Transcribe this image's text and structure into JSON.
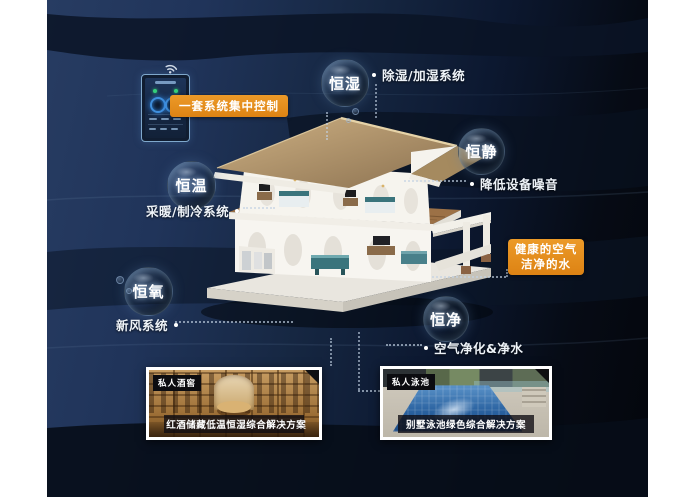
{
  "bubbles": [
    {
      "label": "恒湿",
      "callout": "除湿/加湿系统"
    },
    {
      "label": "恒静",
      "callout": "降低设备噪音"
    },
    {
      "label": "恒温",
      "callout": "采暖/制冷系统"
    },
    {
      "label": "恒氧",
      "callout": "新风系统"
    },
    {
      "label": "恒净",
      "callout": "空气净化&净水"
    }
  ],
  "control_tag": "一套系统集中控制",
  "benefit_tag": {
    "line1": "健康的空气",
    "line2": "洁净的水"
  },
  "cards": [
    {
      "tag": "私人酒窖",
      "caption": "红酒储藏低温恒湿综合解决方案"
    },
    {
      "tag": "私人泳池",
      "caption": "别墅泳池绿色综合解决方案"
    }
  ],
  "colors": {
    "accent_orange": "#e2891e",
    "deep_navy": "#20345a",
    "near_black": "#04060c",
    "bubble_text": "#ffffff",
    "roof_tan": "#b89a6d",
    "pool_blue": "#2a62a0",
    "wood_brown": "#9a6c34"
  },
  "icons": {
    "wifi": "wifi-icon",
    "bullet_dot": "connector-dot",
    "corner_ribbon": "corner-ribbon-icon"
  }
}
